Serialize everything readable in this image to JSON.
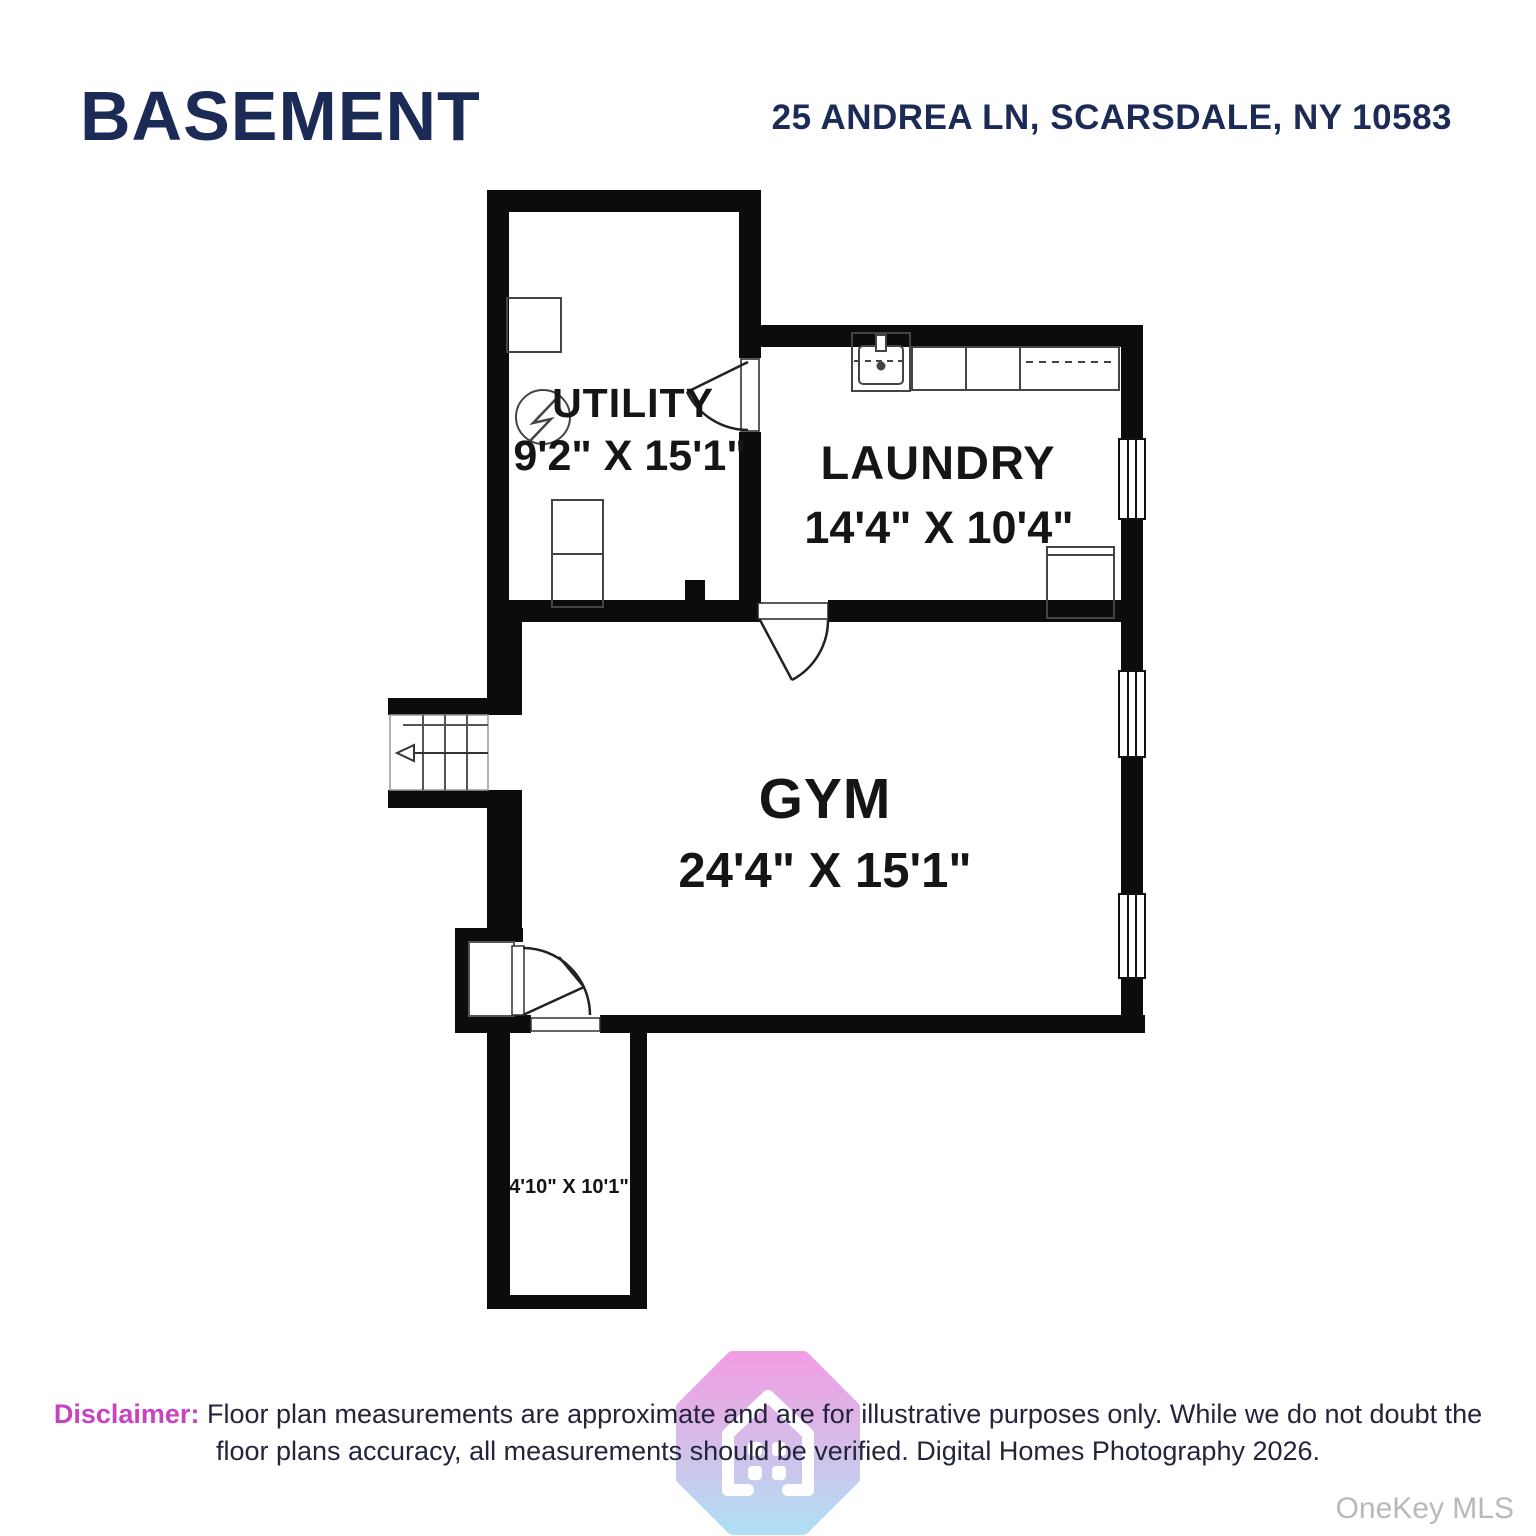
{
  "header": {
    "title": "BASEMENT",
    "address": "25 ANDREA LN, SCARSDALE, NY 10583"
  },
  "floorplan": {
    "rooms": [
      {
        "name": "UTILITY",
        "dims": "9'2\" X 15'1\""
      },
      {
        "name": "LAUNDRY",
        "dims": "14'4\" X 10'4\""
      },
      {
        "name": "GYM",
        "dims": "24'4\" X 15'1\""
      },
      {
        "name": "",
        "dims": "4'10\" X 10'1\""
      }
    ],
    "symbols": [
      "stairs-with-direction-arrow",
      "door-swing",
      "window",
      "sink",
      "laundry-counter",
      "water-heater",
      "hvac-unit",
      "appliance"
    ]
  },
  "footer": {
    "disclaimer_label": "Disclaimer:",
    "line1": "Floor plan measurements are approximate and are for illustrative purposes only. While we do not doubt the",
    "line2": "floor plans accuracy, all measurements should be verified. Digital Homes Photography 2026."
  },
  "watermark": "OneKey MLS",
  "colors": {
    "heading_navy": "#1c2a56",
    "wall_black": "#0c0c0c",
    "disclaimer_pink": "#c743c1",
    "logo_gradient_top": "#ec86dd",
    "logo_gradient_bottom": "#9ed7f0",
    "watermark_gray": "#b9b9b9"
  }
}
